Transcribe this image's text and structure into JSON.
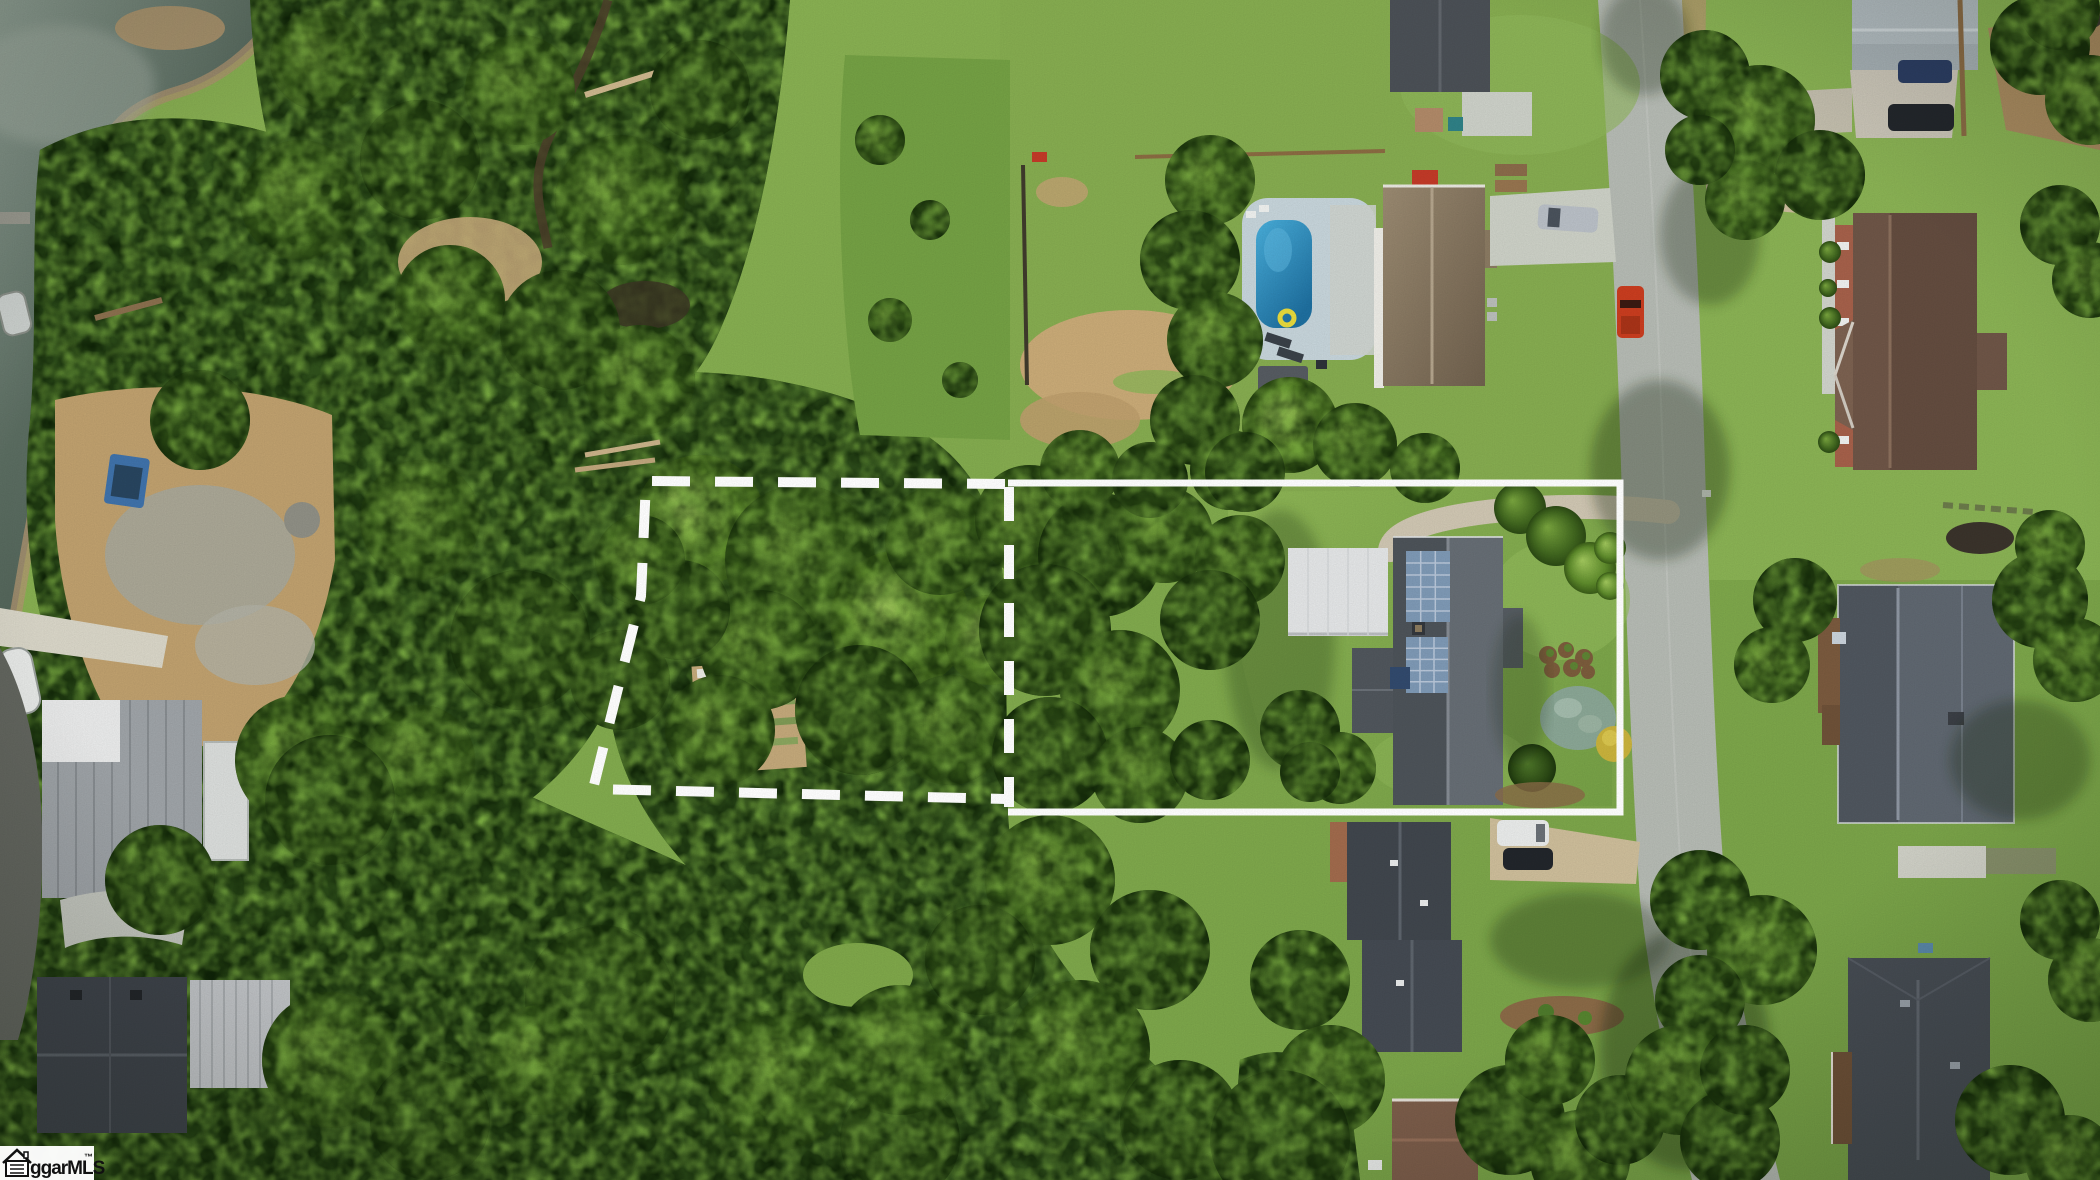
{
  "scene": {
    "type": "aerial-drone-photo",
    "description": "Overhead aerial photo of a wooded residential area: a lake shore at upper left, a dashed-outline wooded parcel and a solid-outline parcel containing a house with rooftop solar panels and a white carport, a neighbor house with swimming pool to the north, a street running along the right side with neighboring homes, dense tree canopy across the left and bottom."
  },
  "watermark": {
    "brand": "ggarMLS",
    "trademark": "™",
    "icon": "house-icon",
    "background": "#ffffff",
    "text_color": "#111111"
  },
  "overlay": {
    "boundary_color": "#ffffff",
    "solid_parcel_path": "M1008,483 L1620,483 L1620,812 L1008,812",
    "shared_edge_path": "M1009,487 L1009,807",
    "dashed_parcel_points": "1005,484 646,481 641,596 593,789 1006,799"
  },
  "palette": {
    "water": "#55675c",
    "water_glint": "#9aa89d",
    "forest": "#33541e",
    "forest_shadow": "#162a0c",
    "canopy_bright": "#7fae45",
    "lawn": "#7da64a",
    "lawn_bright": "#8fb658",
    "meadow": "#74a044",
    "dirt": "#c3a273",
    "gravel": "#a6a699",
    "asphalt_drive": "#63665f",
    "road": "#b5bab3",
    "concrete": "#ccd0c6",
    "carport_roof": "#e3e5e6",
    "subject_roof": "#575d63",
    "solar_panel": "#7e99b5",
    "pool_water": "#2e93c6",
    "pool_deck": "#c6d4da",
    "pool_house_roof": "#8d7d67",
    "brick_house_roof": "#6e5547",
    "slate_house_roof": "#5f6770",
    "south_house_roof": "#40464d",
    "metal_building_roof": "#9ea3a7",
    "red_truck": "#c93d1f",
    "white_van": "#e9ebea",
    "boundary": "#ffffff"
  },
  "objects": [
    "lake",
    "wooded-dashed-parcel",
    "solid-boundary-parcel",
    "house-with-solar-panels",
    "carport",
    "swimming-pool",
    "neighborhood-road",
    "red-pickup-truck",
    "silver-suv",
    "dark-blue-sedan",
    "dark-suv",
    "white-van",
    "dark-sedan",
    "blue-utility-trailer",
    "white-boat",
    "metal-roof-outbuilding",
    "garden-plot",
    "creek"
  ]
}
